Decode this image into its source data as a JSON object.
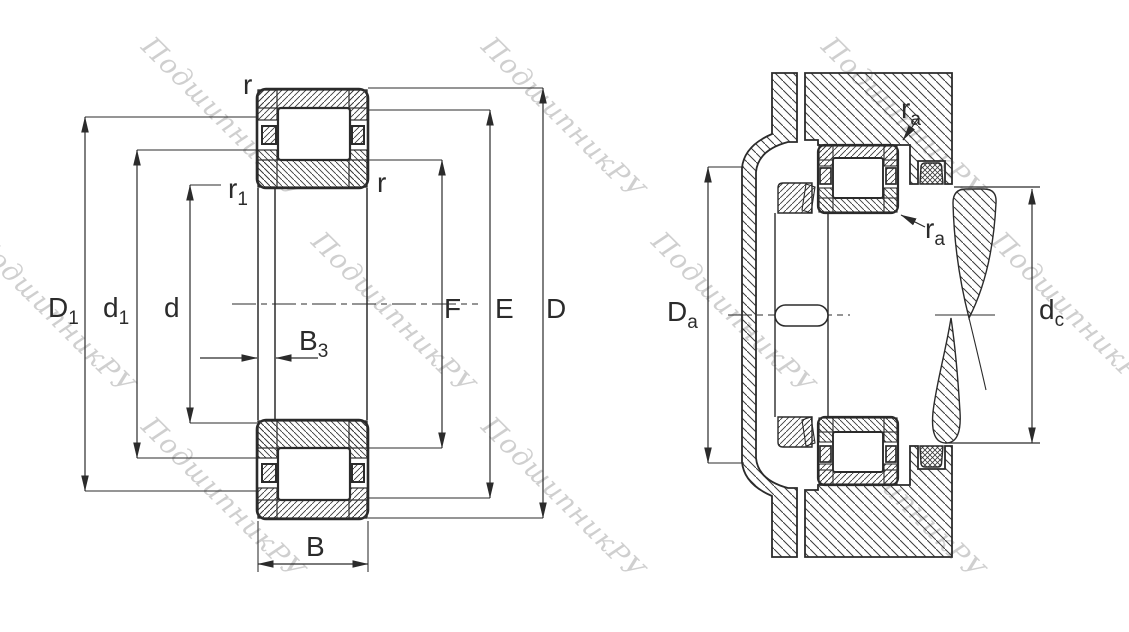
{
  "colors": {
    "line": "#2b2b2b",
    "hatch": "#3a3a3a",
    "watermark": "#c7c7c7",
    "background": "#ffffff"
  },
  "watermark": {
    "text": "ПодшипникРУ"
  },
  "left_figure": {
    "description": "cylindrical-roller-bearing-cross-section-boundary-dimensions",
    "labels": {
      "r_top": "r",
      "r1": {
        "main": "r",
        "sub": "1"
      },
      "r_right": "r",
      "D1": {
        "main": "D",
        "sub": "1"
      },
      "d1": {
        "main": "d",
        "sub": "1"
      },
      "d": "d",
      "B3": {
        "main": "B",
        "sub": "3"
      },
      "B": "B",
      "F": "F",
      "E": "E",
      "D": "D"
    }
  },
  "right_figure": {
    "description": "mounted-bearing-abutment-dimensions",
    "labels": {
      "ra_top": {
        "main": "r",
        "sub": "a"
      },
      "ra_bottom": {
        "main": "r",
        "sub": "a"
      },
      "Da": {
        "main": "D",
        "sub": "a"
      },
      "dc": {
        "main": "d",
        "sub": "c"
      }
    }
  }
}
